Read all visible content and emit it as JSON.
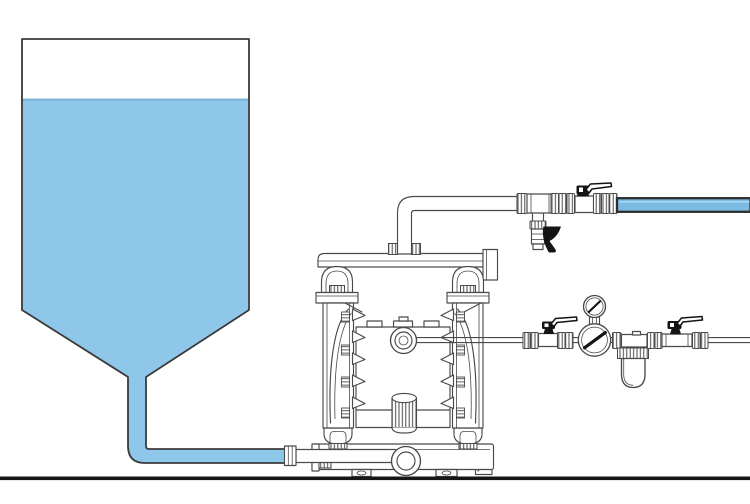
{
  "scene": {
    "width": 750,
    "height": 504,
    "description": "Technical line illustration: gravity-fed supply tank of blue liquid feeding an air-operated double-diaphragm pump; valved fluid discharge line ending in a blue hose at top right; compressed-air supply line with ball valves, pressure regulator, gauge and air filter at middle right; ground line at the bottom."
  },
  "colors": {
    "background": "#ffffff",
    "liquid": "#8ec7e9",
    "liquid_surface": "#7db4d8",
    "tank_outline": "#3a3a3a",
    "line_art": "#4a4a4a",
    "handle_black": "#141414",
    "hose_fill": "#7cbce4",
    "hose_highlight": "#a9d6f0",
    "hose_outline": "#2e2e2e",
    "ground": "#161616"
  },
  "components": [
    "supply-tank",
    "stored-liquid",
    "liquid-surface",
    "gravity-feed-suction-line",
    "hose-ferrule",
    "double-diaphragm-pump",
    "pump-top-manifold",
    "pump-outlet-threads",
    "pump-left-chamber",
    "pump-right-chamber",
    "pump-air-valve-port",
    "pump-muffler",
    "pump-bottom-manifold",
    "pump-inlet-elbow",
    "pump-feet",
    "discharge-pipe",
    "discharge-tee",
    "drain-valve",
    "discharge-ball-valve",
    "discharge-hose",
    "air-supply-pipe",
    "air-ball-valve-upstream",
    "air-pressure-regulator",
    "air-pressure-gauge",
    "air-filter",
    "air-ball-valve-downstream",
    "ground-line"
  ]
}
